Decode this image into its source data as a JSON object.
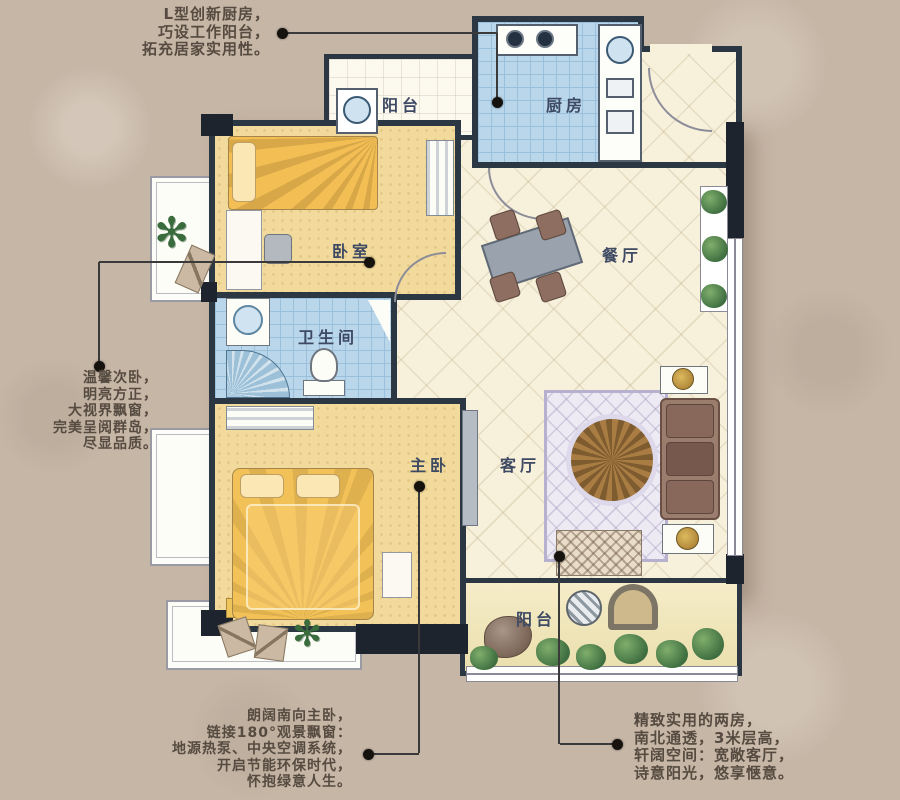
{
  "rooms": {
    "balcony_top": "阳台",
    "kitchen": "厨房",
    "bedroom": "卧室",
    "dining": "餐厅",
    "bathroom": "卫生间",
    "master_bedroom": "主卧",
    "living": "客厅",
    "balcony_bottom": "阳台"
  },
  "annotations": {
    "kitchen_note": [
      "L型创新厨房，",
      "巧设工作阳台，",
      "拓充居家实用性。"
    ],
    "bedroom_note": [
      "温馨次卧，",
      "明亮方正，",
      "大视界飘窗，",
      "完美呈阅群岛，",
      "尽显品质。"
    ],
    "master_note": [
      "朗阔南向主卧，",
      "链接180°观景飘窗：",
      "地源热泵、中央空调系统，",
      "开启节能环保时代，",
      "怀抱绿意人生。"
    ],
    "layout_note": [
      "精致实用的两房，",
      "南北通透，3米层高，",
      "轩阔空间：宽敞客厅，",
      "诗意阳光，悠享惬意。"
    ]
  },
  "icons": {
    "plant": "✻"
  },
  "colors": {
    "background": "#c6b6a6",
    "wall": "#2c3744",
    "floor_cream": "#f7f0da",
    "floor_yellow": "#f1da9b",
    "floor_blue": "#b9d6ea",
    "label_text": "#3e4a63",
    "annotation_text": "#564b40",
    "greenery": "#3f6f40"
  }
}
